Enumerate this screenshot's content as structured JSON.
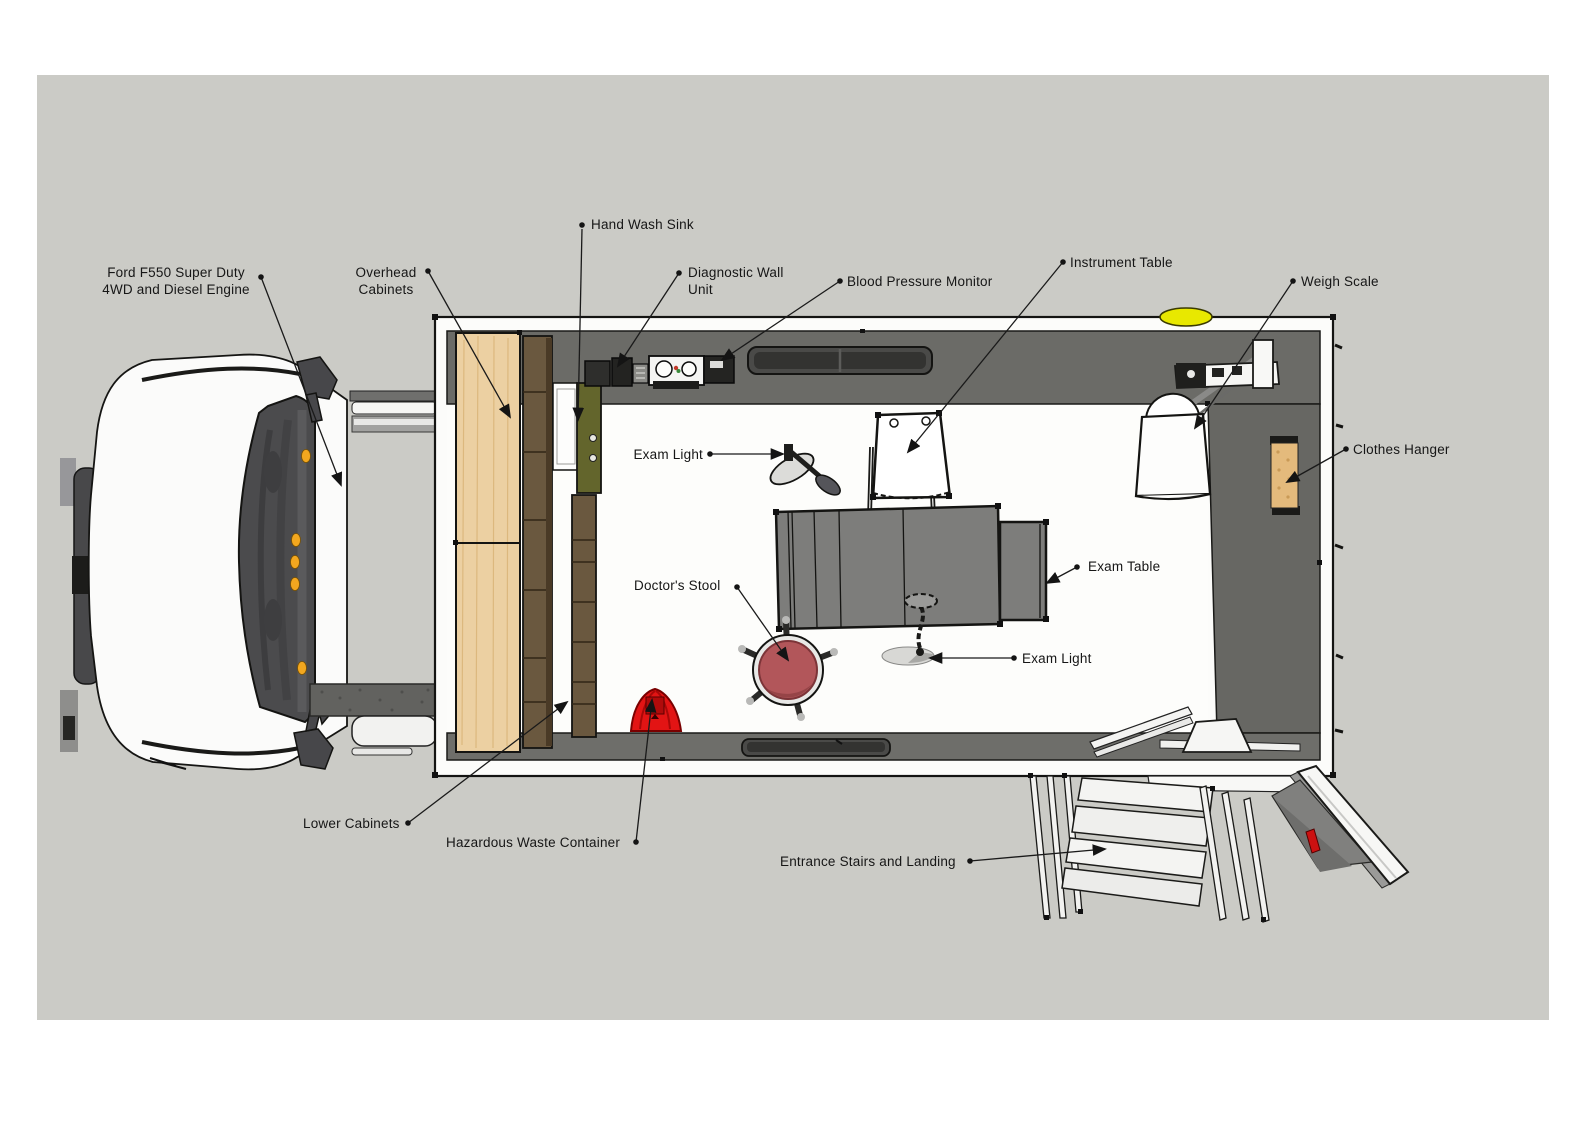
{
  "diagram_title": "",
  "annotations": [
    {
      "id": "ford-f550",
      "text": "Ford F550 Super Duty\n4WD and Diesel Engine"
    },
    {
      "id": "overhead-cabinets",
      "text": "Overhead\nCabinets"
    },
    {
      "id": "hand-wash-sink",
      "text": "Hand Wash Sink"
    },
    {
      "id": "diagnostic-wall-unit",
      "text": "Diagnostic Wall\nUnit"
    },
    {
      "id": "blood-pressure-monitor",
      "text": "Blood Pressure Monitor"
    },
    {
      "id": "instrument-table",
      "text": "Instrument Table"
    },
    {
      "id": "weigh-scale",
      "text": "Weigh Scale"
    },
    {
      "id": "clothes-hanger",
      "text": "Clothes Hanger"
    },
    {
      "id": "exam-light-left",
      "text": "Exam Light"
    },
    {
      "id": "exam-table",
      "text": "Exam Table"
    },
    {
      "id": "doctors-stool",
      "text": "Doctor's Stool"
    },
    {
      "id": "exam-light-center",
      "text": "Exam Light"
    },
    {
      "id": "lower-cabinets",
      "text": "Lower Cabinets"
    },
    {
      "id": "hazardous-waste-container",
      "text": "Hazardous Waste Container"
    },
    {
      "id": "entrance-stairs",
      "text": "Entrance Stairs and Landing"
    }
  ],
  "colors": {
    "canvas_background": "#cbcbc6",
    "wall_interior": "#6a6a66",
    "floor": "#fdfdfb",
    "overhead_cabinet_wood": "#ecd0a2",
    "lower_cabinet_wood": "#6a583f",
    "sink_unit_olive": "#63652c",
    "exam_table_gray": "#7d7d7b",
    "stool_red": "#b2565a",
    "hazard_red": "#e21414",
    "roof_light_yellow": "#e8e800",
    "clothes_hanger_tan": "#e4ba7c",
    "leader_line": "#1a1a1a"
  }
}
